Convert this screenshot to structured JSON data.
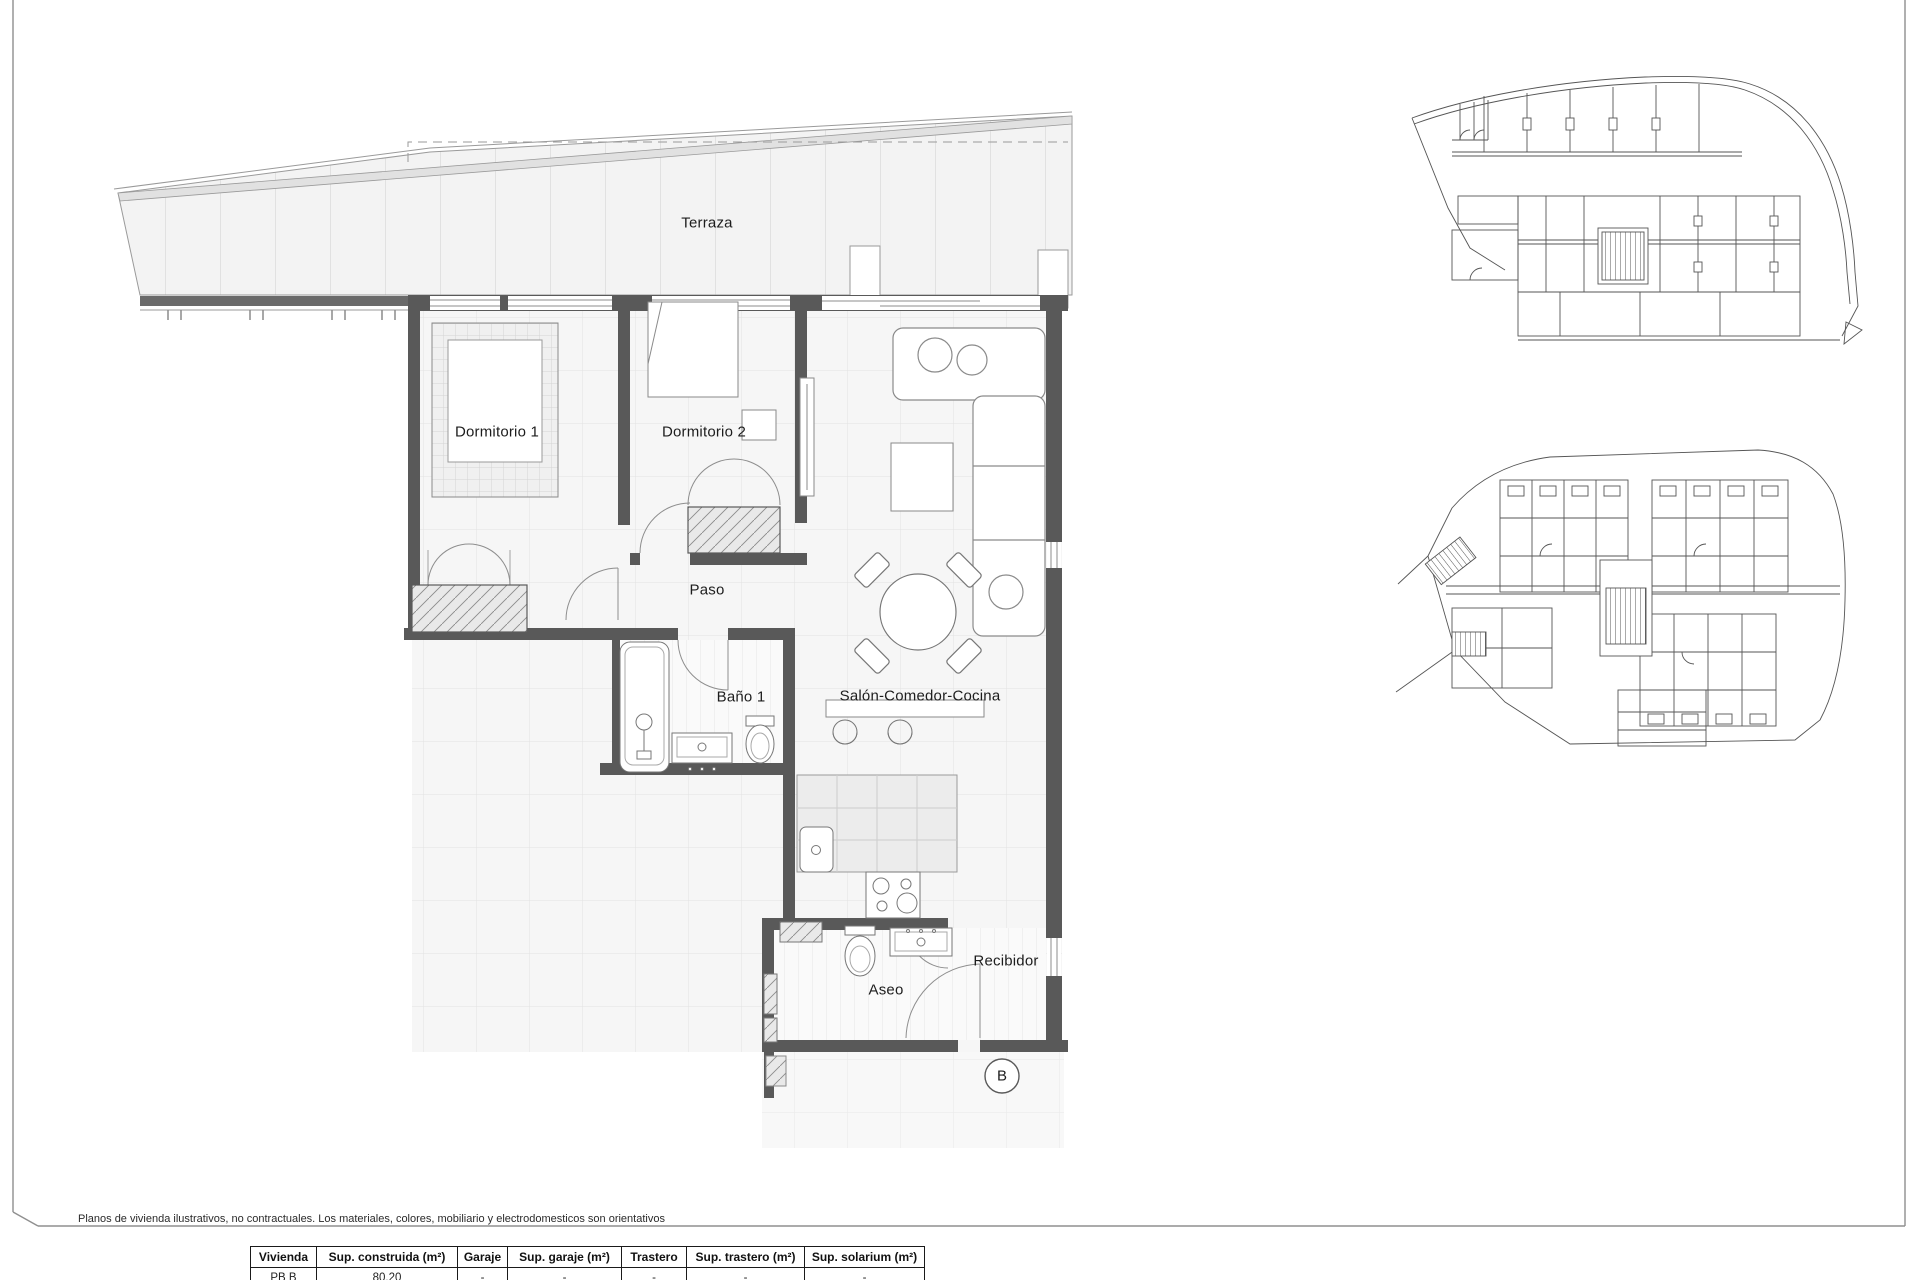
{
  "sheet": {
    "disclaimer": "Planos de vivienda ilustrativos, no contractuales. Los materiales, colores, mobiliario y electrodomesticos son orientativos"
  },
  "floorplan": {
    "rooms": {
      "terraza": "Terraza",
      "dormitorio1": "Dormitorio 1",
      "dormitorio2": "Dormitorio 2",
      "paso": "Paso",
      "bano1": "Baño 1",
      "salon": "Salón-Comedor-Cocina",
      "aseo": "Aseo",
      "recibidor": "Recibidor"
    },
    "unit_marker": "B"
  },
  "table": {
    "headers": [
      "Vivienda",
      "Sup. construida (m²)",
      "Garaje",
      "Sup. garaje (m²)",
      "Trastero",
      "Sup. trastero (m²)",
      "Sup. solarium (m²)"
    ],
    "rows": [
      [
        "PB B",
        "80.20",
        "-",
        "-",
        "-",
        "-",
        "-"
      ]
    ]
  },
  "colors": {
    "wall": "#595959",
    "thin_line": "#999999",
    "tile_line": "#dedede",
    "paper": "#ffffff"
  }
}
